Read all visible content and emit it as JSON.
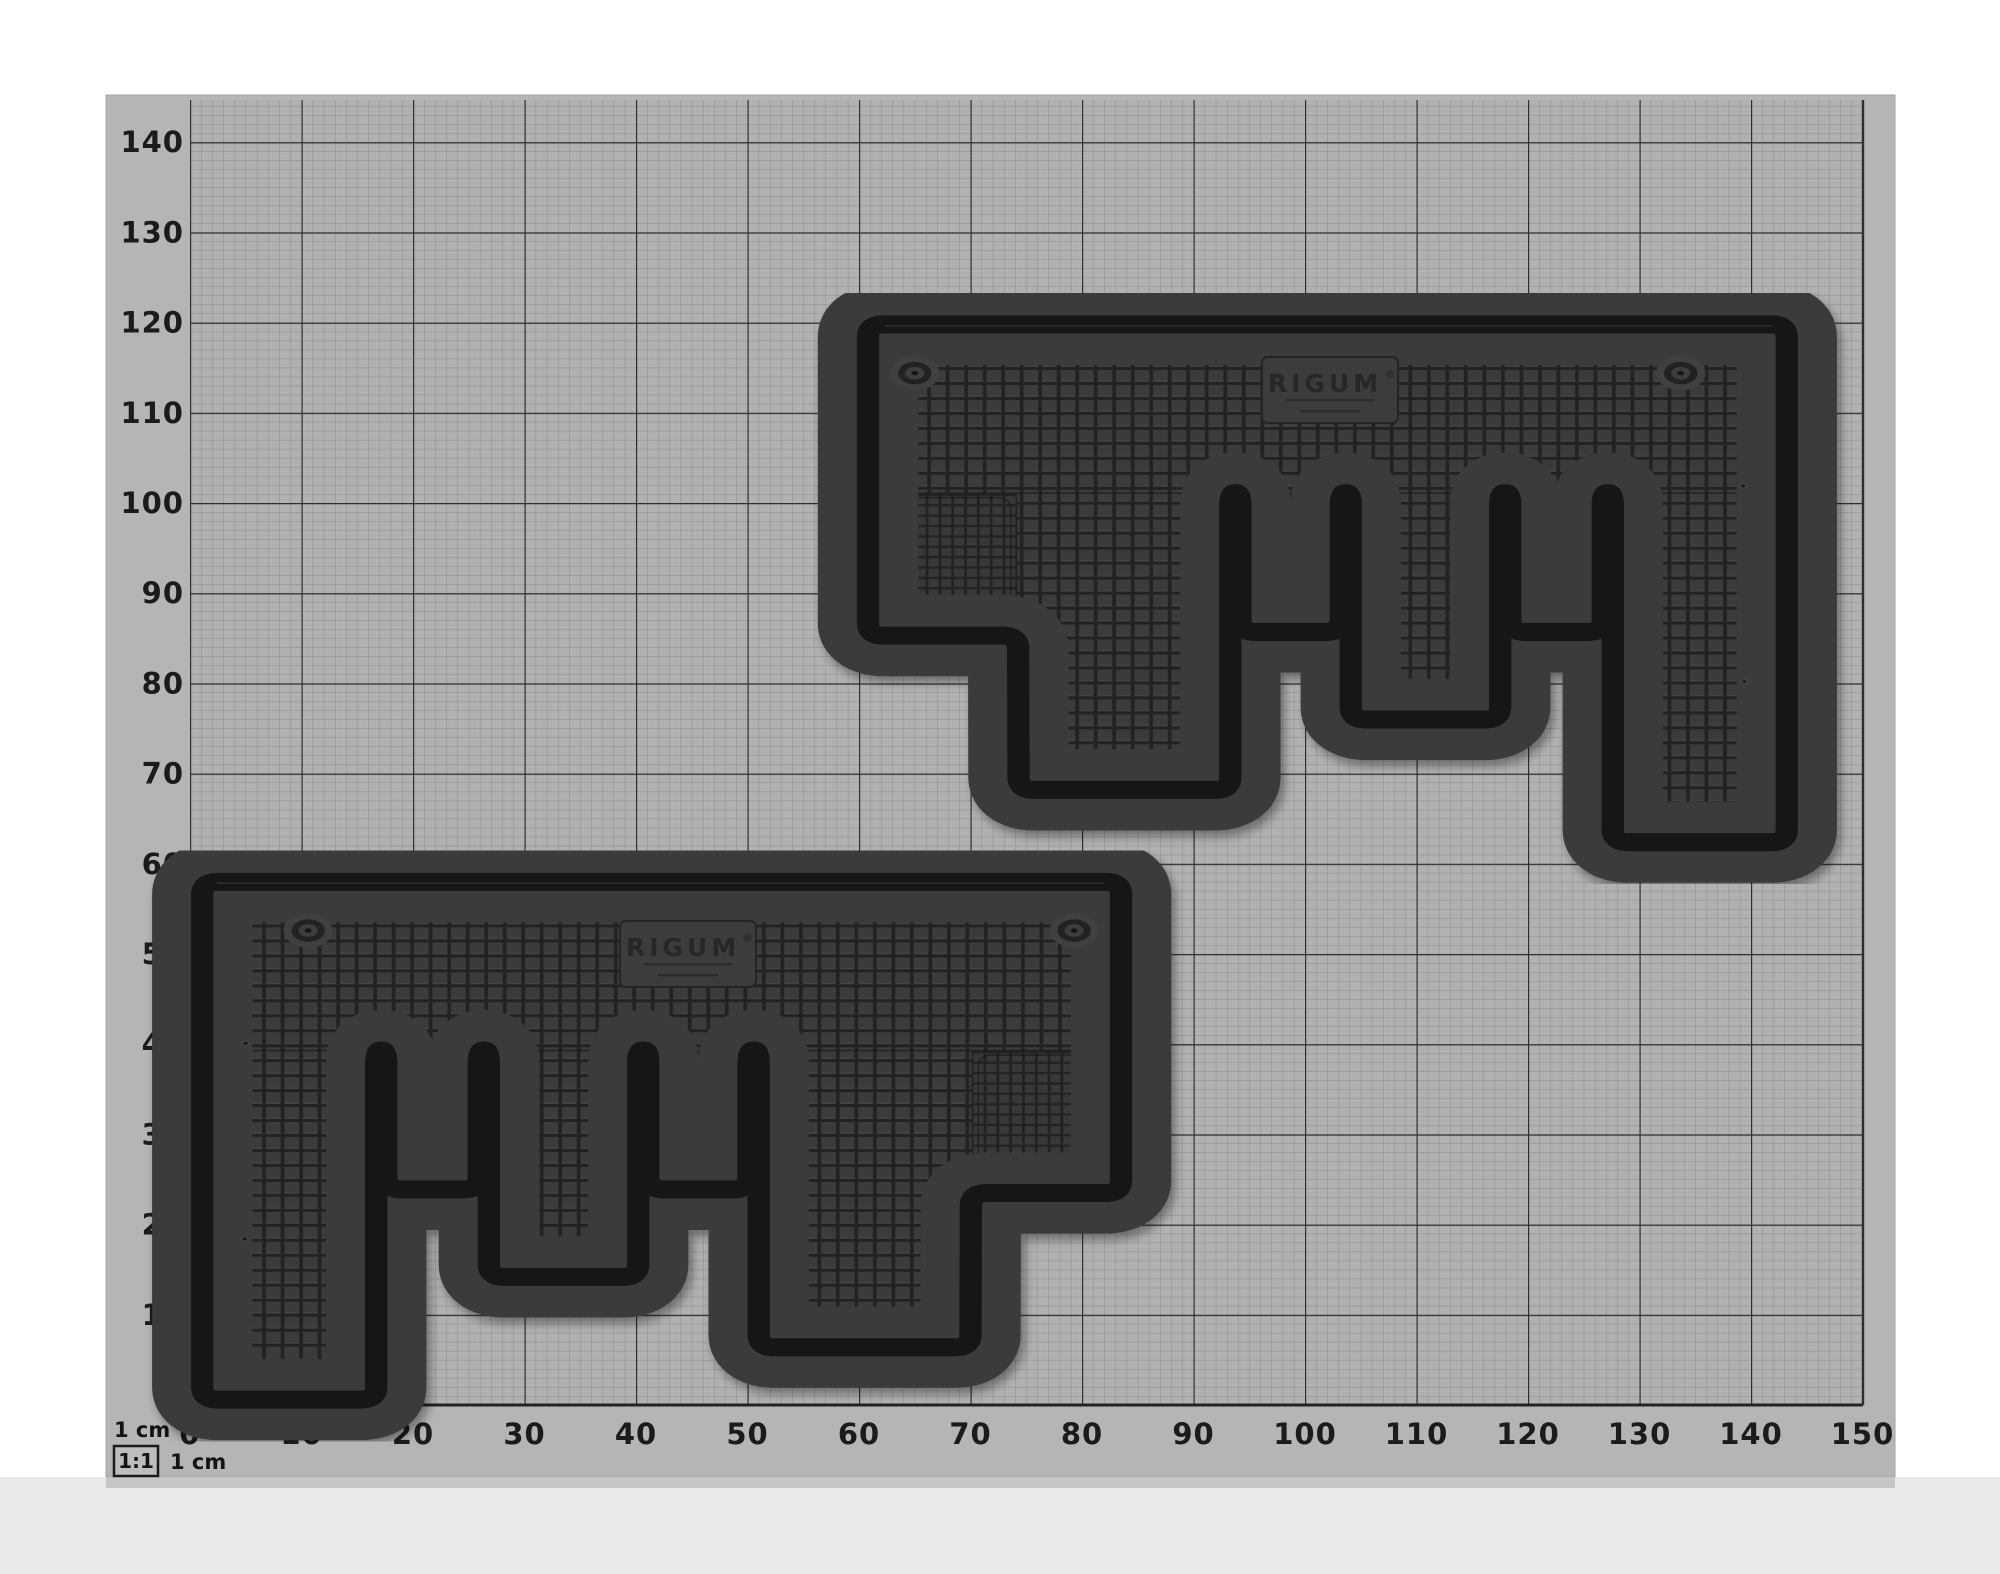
{
  "axes": {
    "x_labels": [
      "0",
      "10",
      "20",
      "30",
      "40",
      "50",
      "60",
      "70",
      "80",
      "90",
      "100",
      "110",
      "120",
      "130",
      "140",
      "150"
    ],
    "y_labels": [
      "140",
      "130",
      "120",
      "110",
      "100",
      "90",
      "80",
      "70",
      "60",
      "50",
      "40",
      "30",
      "20",
      "10"
    ]
  },
  "legend": {
    "top_label": "1 cm",
    "ratio_label": "1:1",
    "bottom_label": "1 cm"
  },
  "mats": {
    "count": 2,
    "brand_label": "RIGUM",
    "brand_reg": "®"
  },
  "colors": {
    "paper": "#b5b5b5",
    "grid_major": "#2e2e2e",
    "grid_minor": "#838383",
    "label": "#1b1b1b",
    "mat_base": "#262626",
    "mat_tile": "#3a3a3a",
    "mat_rim": "#3a3a3a",
    "mat_outline": "#161616",
    "backdrop_bottom": "#eaeaea",
    "page_background": "#ffffff"
  }
}
